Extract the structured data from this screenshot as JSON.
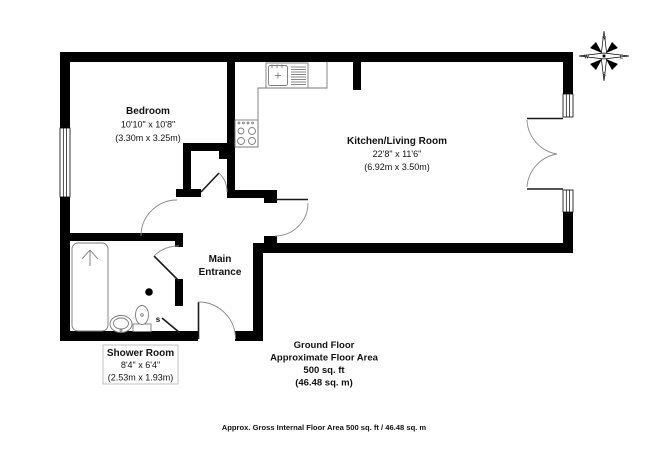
{
  "floorplan": {
    "bedroom": {
      "name": "Bedroom",
      "imperial": "10'10\" x 10'8\"",
      "metric": "(3.30m x 3.25m)"
    },
    "kitchen_living": {
      "name": "Kitchen/Living Room",
      "imperial": "22'8\" x 11'6\"",
      "metric": "(6.92m x 3.50m)"
    },
    "shower_room": {
      "name": "Shower Room",
      "imperial": "8'4\" x 6'4\"",
      "metric": "(2.53m x 1.93m)"
    },
    "entrance": {
      "line1": "Main",
      "line2": "Entrance"
    },
    "area_summary": {
      "line1": "Ground Floor",
      "line2": "Approximate Floor Area",
      "line3": "500 sq. ft",
      "line4": "(46.48 sq. m)"
    },
    "footer": "Approx. Gross Internal Floor Area 500 sq. ft / 46.48 sq. m",
    "cupboard_label": "s",
    "compass": {
      "north": "N",
      "east": "E",
      "south": "S",
      "west": "W"
    },
    "colors": {
      "wall": "#000000",
      "door_arc": "#8a8a8a",
      "fixture_line": "#7a7a7a",
      "text": "#111111",
      "label_box_border": "#b3b3b3"
    }
  }
}
